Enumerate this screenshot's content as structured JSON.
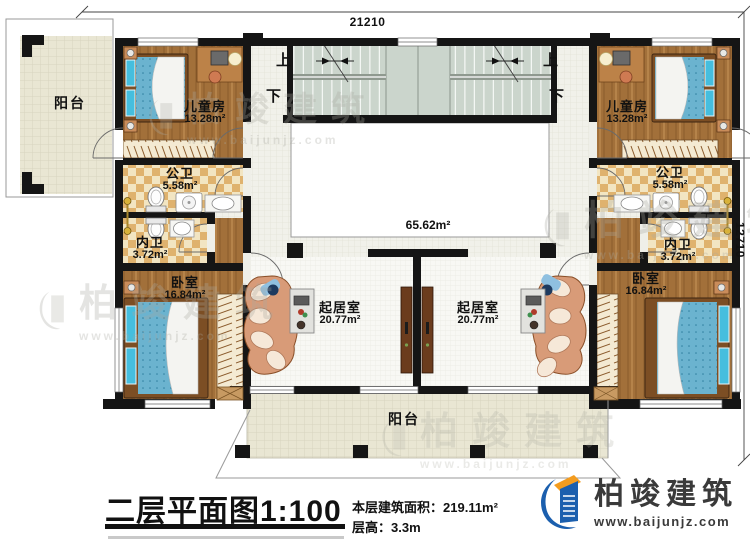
{
  "plan": {
    "dimensions": {
      "width_mm": "21210",
      "depth_mm": "12710"
    },
    "hall_area": "65.62m²",
    "stairs": {
      "up": "上",
      "down": "下"
    },
    "rooms": [
      {
        "id": "balcony-top-left",
        "label": "阳台",
        "area": ""
      },
      {
        "id": "children-left",
        "label": "儿童房",
        "area": "13.28m²"
      },
      {
        "id": "public-bath-left",
        "label": "公卫",
        "area": "5.58m²"
      },
      {
        "id": "private-bath-left",
        "label": "内卫",
        "area": "3.72m²"
      },
      {
        "id": "bedroom-left",
        "label": "卧室",
        "area": "16.84m²"
      },
      {
        "id": "living-left",
        "label": "起居室",
        "area": "20.77m²"
      },
      {
        "id": "living-right",
        "label": "起居室",
        "area": "20.77m²"
      },
      {
        "id": "bedroom-right",
        "label": "卧室",
        "area": "16.84m²"
      },
      {
        "id": "private-bath-right",
        "label": "内卫",
        "area": "3.72m²"
      },
      {
        "id": "public-bath-right",
        "label": "公卫",
        "area": "5.58m²"
      },
      {
        "id": "children-right",
        "label": "儿童房",
        "area": "13.28m²"
      },
      {
        "id": "balcony-bottom",
        "label": "阳台",
        "area": ""
      }
    ]
  },
  "title_block": {
    "title": "二层平面图1:100",
    "area_label": "本层建筑面积：",
    "area_value": "219.11m²",
    "height_label": "层高：",
    "height_value": "3.3m"
  },
  "brand": {
    "name": "柏竣建筑",
    "url": "www.baijunjz.com"
  },
  "watermark": {
    "text": "柏竣建筑",
    "url": "www.baijunjz.com"
  },
  "colors": {
    "wall": "#151515",
    "wood": "#a2703a",
    "tile": "#e9e6d3",
    "checker": "#dfb26e",
    "stair": "#cbd5cc",
    "bed_blue": "#6bb3cf",
    "brand_blue": "#1b5fae",
    "brand_orange": "#f39c1f"
  }
}
